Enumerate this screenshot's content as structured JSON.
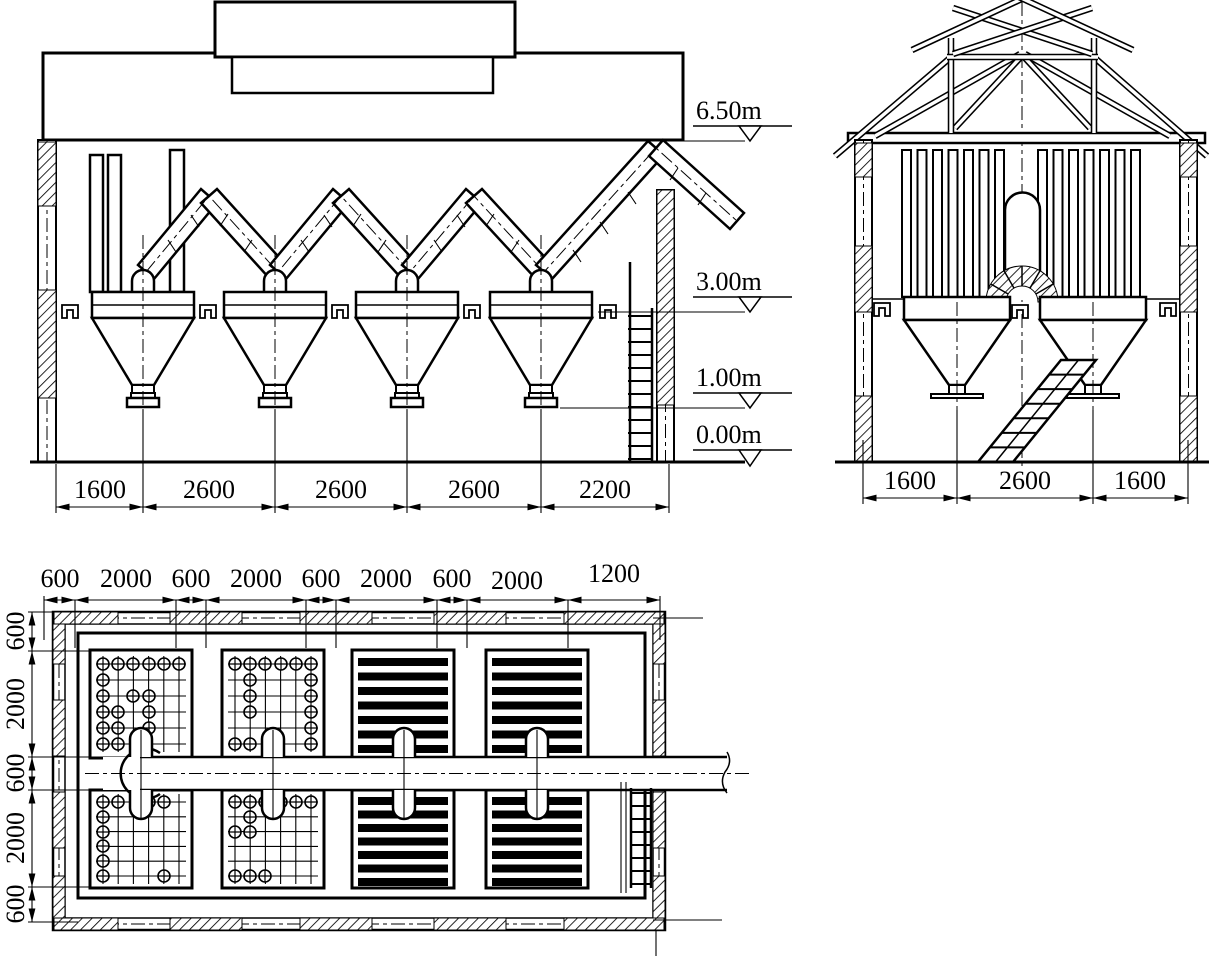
{
  "front_view": {
    "dims": [
      "1600",
      "2600",
      "2600",
      "2600",
      "2200"
    ],
    "levels": [
      "6.50m",
      "3.00m",
      "1.00m",
      "0.00m"
    ]
  },
  "side_view": {
    "dims": [
      "1600",
      "2600",
      "1600"
    ]
  },
  "plan_view": {
    "dims_top": [
      "600",
      "2000",
      "600",
      "2000",
      "600",
      "2000",
      "600",
      "2000",
      "1200"
    ],
    "dims_left": [
      "600",
      "2000",
      "600",
      "2000",
      "600"
    ]
  },
  "colors": {
    "ink": "#000000",
    "paper": "#ffffff"
  }
}
